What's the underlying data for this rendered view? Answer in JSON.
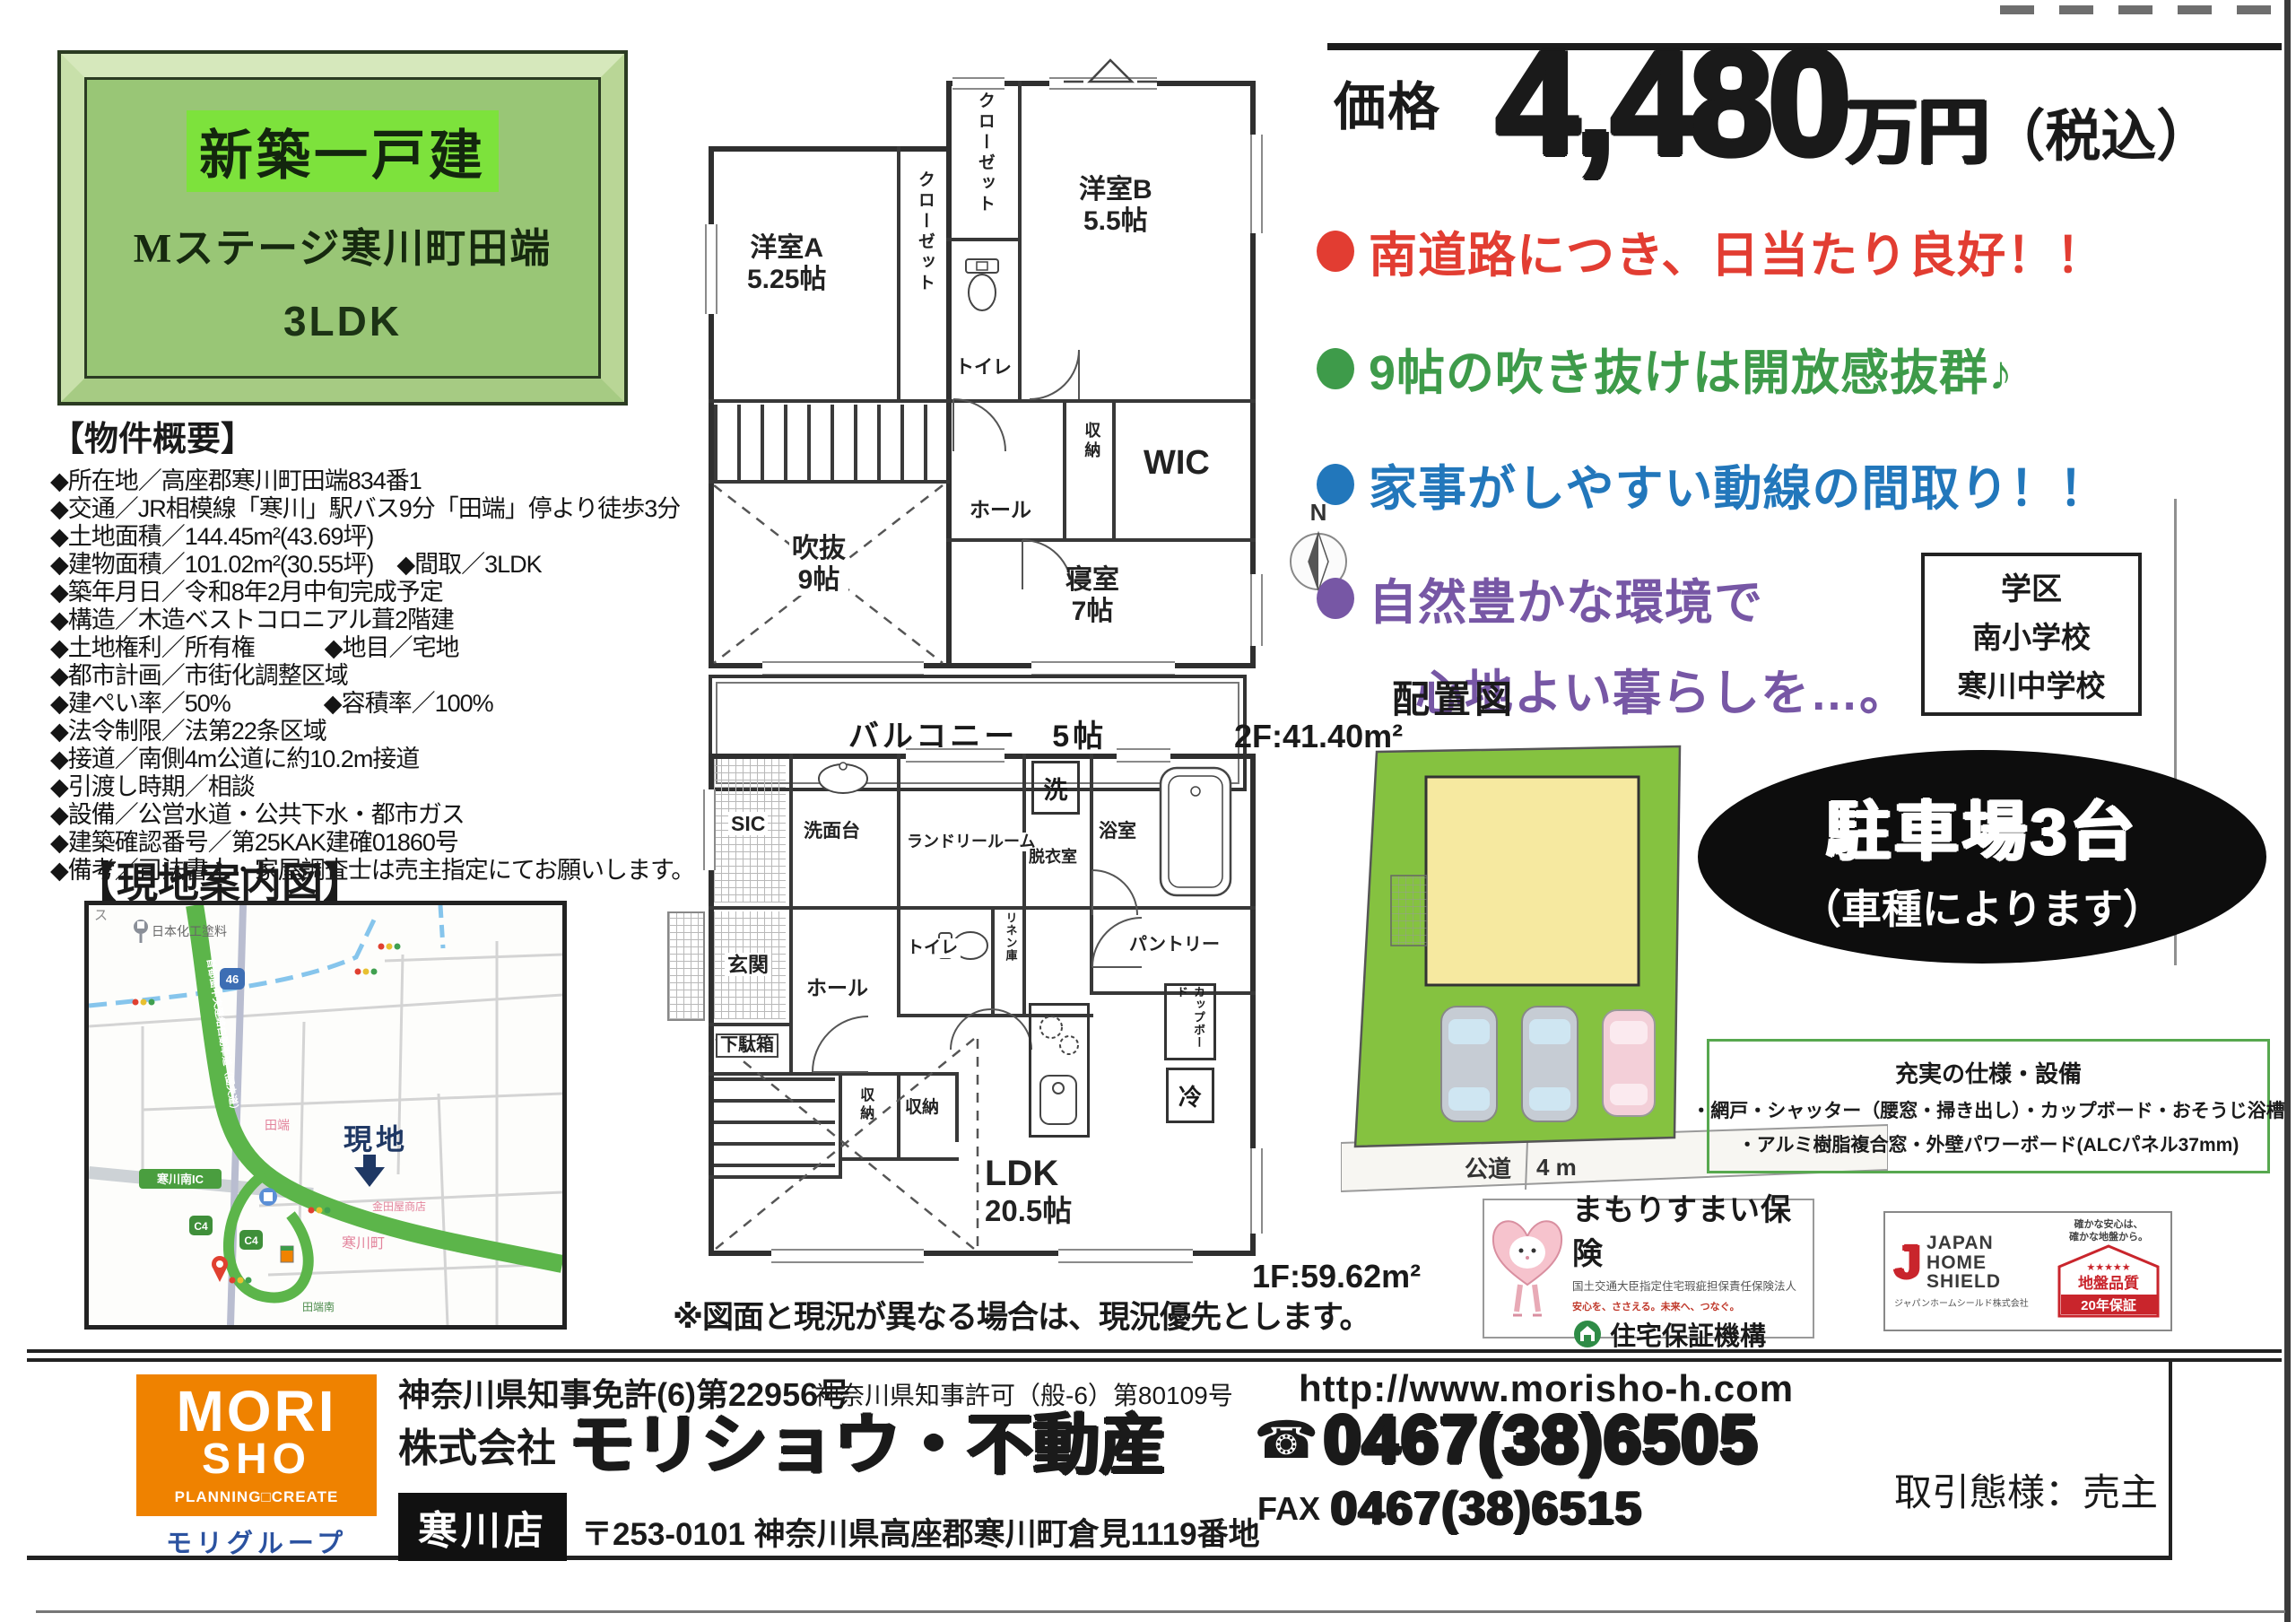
{
  "colors": {
    "accent_red": "#e23d32",
    "accent_green": "#3e9b4a",
    "accent_blue": "#2277bb",
    "accent_purple": "#7757a5",
    "brand_orange": "#ef8200",
    "lot_green": "#85c240",
    "house_yellow": "#f6e9a0",
    "title_panel_green": "#99c676",
    "highlight_green": "#7de23c",
    "jhs_red": "#c9252c",
    "hosho_green": "#2e8b46",
    "group_blue": "#2b52a0"
  },
  "title_box": {
    "badge": "新築一戸建",
    "name": "Mステージ寒川町田端",
    "plan": "3LDK"
  },
  "overview": {
    "heading": "【物件概要】",
    "items": [
      "◆所在地／高座郡寒川町田端834番1",
      "◆交通／JR相模線「寒川」駅バス9分「田端」停より徒歩3分",
      "◆土地面積／144.45m²(43.69坪)",
      "◆建物面積／101.02m²(30.55坪)　◆間取／3LDK",
      "◆築年月日／令和8年2月中旬完成予定",
      "◆構造／木造ベストコロニアル葺2階建",
      "◆土地権利／所有権　　　◆地目／宅地",
      "◆都市計画／市街化調整区域",
      "◆建ぺい率／50%　　　　◆容積率／100%",
      "◆法令制限／法第22条区域",
      "◆接道／南側4m公道に約10.2m接道",
      "◆引渡し時期／相談",
      "◆設備／公営水道・公共下水・都市ガス",
      "◆建築確認番号／第25KAK建確01860号",
      "◆備考／司法書士・家屋調査士は売主指定にてお願いします。"
    ]
  },
  "map": {
    "heading": "【現地案内図】",
    "genchi": "現地",
    "paint": "日本化工塗料",
    "ic": "寒川南IC",
    "c4": "C4",
    "route": "46",
    "tabata": "田端",
    "town": "寒川町",
    "shop": "金田屋商店",
    "minami": "田端南",
    "expwy": "首都圏中央連絡自動車道（圏央道）",
    "su": "ス"
  },
  "price": {
    "label": "価格",
    "amount": "4,480",
    "unit": "万円",
    "tax": "（税込）"
  },
  "points": {
    "p1": "南道路につき、日当たり良好！！",
    "p2": "9帖の吹き抜けは開放感抜群♪",
    "p3": "家事がしやすい動線の間取り！！",
    "p4a": "自然豊かな環境で",
    "p4b": "心地よい暮らしを…。"
  },
  "school": {
    "title": "学区",
    "s1": "南小学校",
    "s2": "寒川中学校"
  },
  "compass": {
    "n": "N"
  },
  "plan2f": {
    "area": "2F:41.40m²",
    "closet_top": "クローゼット",
    "closet_a": "クローゼット",
    "toilet": "トイレ",
    "ya_name": "洋室A",
    "ya_size": "5.25帖",
    "yb_name": "洋室B",
    "yb_size": "5.5帖",
    "hall": "ホール",
    "storage": "収納",
    "wic": "WIC",
    "void_name": "吹抜",
    "void_size": "9帖",
    "bed_name": "寝室",
    "bed_size": "7帖",
    "balcony": "バルコニー　5帖"
  },
  "plan1f": {
    "area": "1F:59.62m²",
    "sic": "SIC",
    "senmen": "洗面台",
    "laundry": "ランドリールーム",
    "wash": "洗",
    "datsui": "脱衣室",
    "bath": "浴室",
    "genkan": "玄関",
    "getabako": "下駄箱",
    "hall": "ホール",
    "toilet": "トイレ",
    "linen": "リネン庫",
    "pantry": "パントリー",
    "storage1": "収納",
    "storage2": "収納",
    "cupboard": "カップボード",
    "fridge": "冷",
    "ldk_name": "LDK",
    "ldk_size": "20.5帖"
  },
  "note": "※図面と現況が異なる場合は、現況優先とします。",
  "site": {
    "heading": "配置図",
    "road": "公道",
    "road_width": "4 m"
  },
  "parking": {
    "line1": "駐車場3台",
    "line2": "（車種によります）"
  },
  "specs": {
    "title": "充実の仕様・設備",
    "line1": "・網戸・シャッター（腰窓・掃き出し）・カップボード・おそうじ浴槽",
    "line2": "・アルミ樹脂複合窓・外壁パワーボード(ALCパネル37mm)"
  },
  "mamori": {
    "title": "まもりすまい保険",
    "subtitle": "国土交通大臣指定住宅瑕疵担保責任保険法人",
    "slogan": "安心を、ささえる。未来へ、つなぐ。",
    "org": "住宅保証機構"
  },
  "jhs": {
    "j": "J",
    "b1": "JAPAN",
    "b2": "HOME",
    "b3": "SHIELD",
    "company": "ジャパンホームシールド株式会社",
    "tag1": "確かな安心は、",
    "tag2": "確かな地盤から。",
    "stars": "★★★★★",
    "quality": "地盤品質",
    "warranty": "20年保証"
  },
  "footer": {
    "license1": "神奈川県知事免許(6)第22956号",
    "license2": "神奈川県知事許可（般-6）第80109号",
    "url": "http://www.morisho-h.com",
    "company_prefix": "株式会社",
    "company": "モリショウ・不動産",
    "branch": "寒川店",
    "address": "〒253-0101 神奈川県高座郡寒川町倉見1119番地",
    "tel_icon": "☎",
    "tel": "0467(38)6505",
    "fax_label": "FAX",
    "fax": "0467(38)6515",
    "deal": "取引態様：売主",
    "logo1": "MORI",
    "logo2": "SHO",
    "logo3": "PLANNING□CREATE",
    "group": "モリグループ"
  }
}
